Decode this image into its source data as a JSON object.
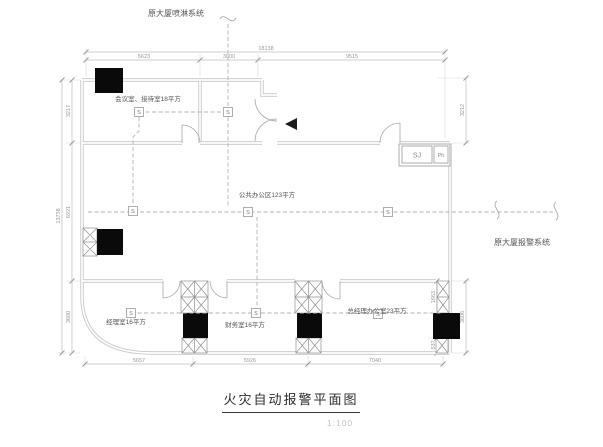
{
  "annotations": {
    "top_system": "原大厦喷淋系统",
    "right_system": "原大厦报警系统"
  },
  "rooms": {
    "meeting": "会议室、接待室18平方",
    "open_office": "公共办公区123平方",
    "manager": "经理室16平方",
    "finance": "财务室16平方",
    "gm_office": "总经理办公室23平方"
  },
  "devices": {
    "detector": "S",
    "sj": "SJ",
    "ph": "Ph"
  },
  "dimensions": {
    "top_overall": "18138",
    "top_segments": [
      "5623",
      "3000",
      "9515"
    ],
    "left_overall": "13738",
    "left_segments": [
      "3217",
      "6921",
      "3600"
    ],
    "right_top": "3212",
    "right_bottom": [
      "1663",
      "637",
      "3606"
    ],
    "bottom_segments": [
      "5657",
      "5926",
      "7040"
    ]
  },
  "title": {
    "text": "火灾自动报警平面图",
    "scale": "1:100"
  }
}
